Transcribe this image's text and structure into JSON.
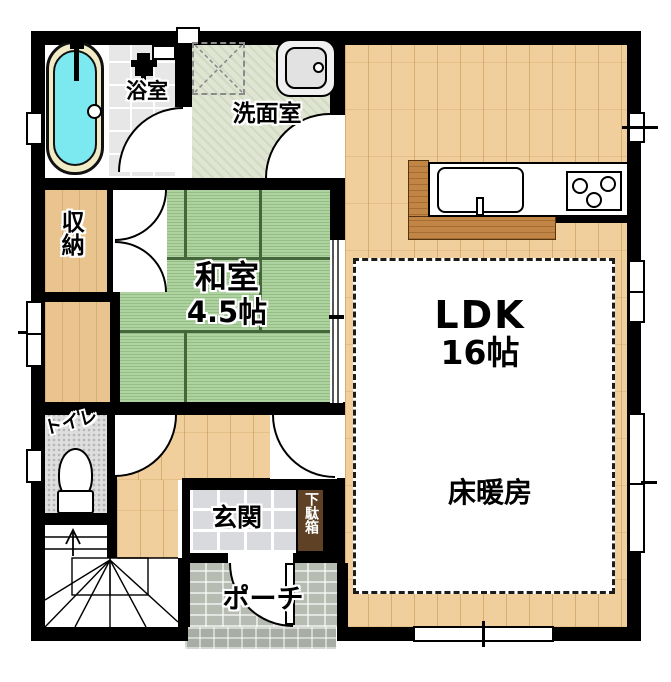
{
  "plan_title": "floor-plan-1f",
  "rooms": {
    "ldk": {
      "label": "LDK",
      "size": "16帖"
    },
    "floor_heating": {
      "label": "床暖房"
    },
    "japanese_room": {
      "label": "和室",
      "size": "4.5帖"
    },
    "washroom": {
      "label": "洗面室"
    },
    "bathroom": {
      "label": "浴室"
    },
    "storage": {
      "label": "収納"
    },
    "toilet": {
      "label": "トイレ"
    },
    "entrance": {
      "label": "玄関"
    },
    "shoe_cabinet": {
      "label": "下駄箱"
    },
    "porch": {
      "label": "ポーチ"
    }
  },
  "fixtures": [
    "bathtub",
    "bath-faucet",
    "shower-faucet",
    "washer-pan",
    "washbasin",
    "kitchen-counter",
    "kitchen-sink",
    "gas-stove",
    "toilet-bowl",
    "stairs-up-arrow",
    "fusuma-sliding-door",
    "hinged-doors",
    "windows"
  ],
  "colors": {
    "wall": "#000000",
    "wood_floor": "#f0cf9c",
    "tatami": "#aed2a0",
    "bath_tile": "#e7e7e7",
    "washroom_floor": "#dfe5d2",
    "entry_marble": "#d9dade",
    "porch_tile": "#b7bcb3",
    "kitchen_counter": "#c18546",
    "bathtub_water": "#7ce8f0",
    "bathtub_rim": "#f2ecc6",
    "shoe_cabinet": "#5f4226",
    "heating_area": "#ffffff"
  }
}
